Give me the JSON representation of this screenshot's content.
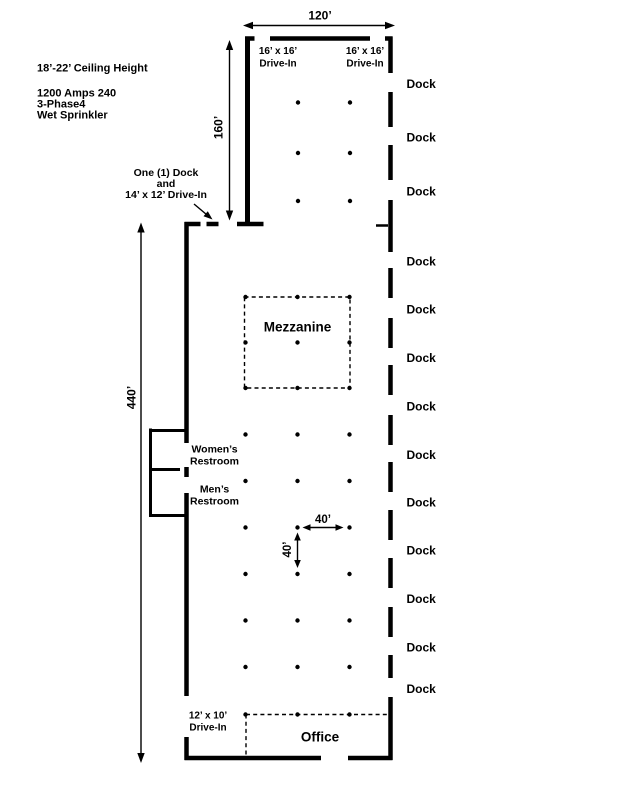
{
  "building": {
    "info": {
      "ceiling": "18’-22’ Ceiling Height",
      "power": "1200 Amps 240",
      "phase": "3-Phase4",
      "sprinkler": "Wet Sprinkler"
    },
    "dimensions": {
      "top_width": "120’",
      "upper_depth": "160’",
      "main_depth": "440’",
      "bay_x": "40’",
      "bay_y": "40’"
    },
    "doors": {
      "drive_in_left_size": "16’ x 16’",
      "drive_in_left_type": "Drive-In",
      "drive_in_right_size": "16’ x 16’",
      "drive_in_right_type": "Drive-In",
      "dock_combo_line1": "One (1) Dock",
      "dock_combo_line2": "and",
      "dock_combo_line3": "14’ x 12’ Drive-In",
      "drive_in_bottom_size": "12’ x 10’",
      "drive_in_bottom_type": "Drive-In"
    },
    "rooms": {
      "mezzanine": "Mezzanine",
      "office": "Office",
      "womens_line1": "Women’s",
      "womens_line2": "Restroom",
      "mens_line1": "Men’s",
      "mens_line2": "Restroom"
    },
    "docks": {
      "label": "Dock",
      "count": 13
    }
  }
}
